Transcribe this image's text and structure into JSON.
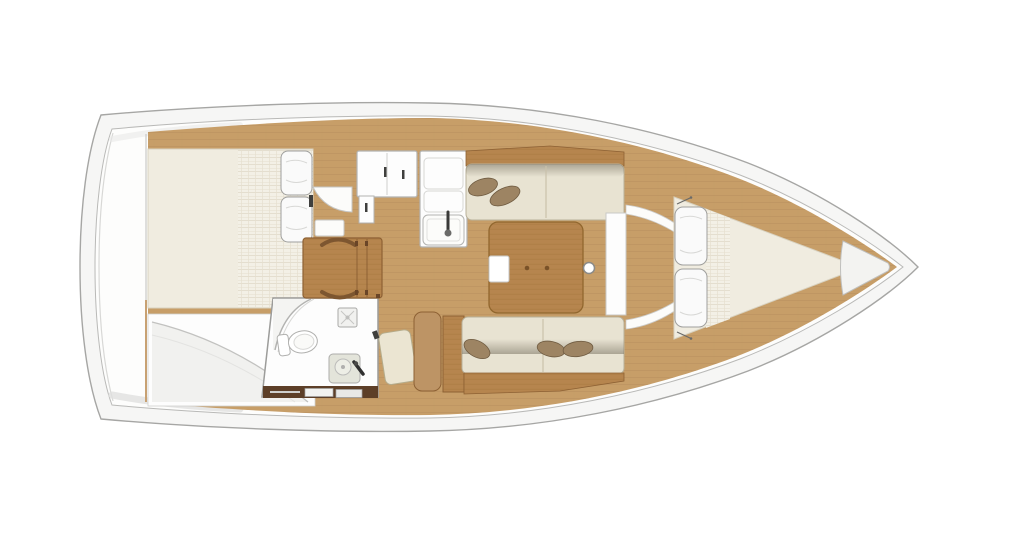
{
  "canvas": {
    "width": 1024,
    "height": 546,
    "background": "#ffffff"
  },
  "diagram": {
    "type": "sailboat-interior-floor-plan",
    "orientation": "stern-left-bow-right",
    "zones": [
      {
        "id": "aft-cabin",
        "description": "aft double berth with quilt and two pillows"
      },
      {
        "id": "aft-seat",
        "description": "curved seat and locker area aft"
      },
      {
        "id": "head",
        "description": "head compartment with shower, toilet, washbasin"
      },
      {
        "id": "galley",
        "description": "L-shaped galley with lockers, stove and sink"
      },
      {
        "id": "nav-station",
        "description": "chart table with bench"
      },
      {
        "id": "salon",
        "description": "two facing settees with throw pillows and centre table"
      },
      {
        "id": "mast-post",
        "description": "mast compression post"
      },
      {
        "id": "bow-cabin",
        "description": "V-berth with two pillows"
      },
      {
        "id": "bow-locker",
        "description": "anchor locker wedge at the stem"
      }
    ]
  },
  "palette": {
    "hull_band": "#f6f6f5",
    "hull_line": "#a6a6a4",
    "deck_white": "#fdfdfc",
    "floor_wood": "#c79e68",
    "furniture_wood": "#b6854e",
    "furniture_wood_line": "#8d6134",
    "trim_wood": "#bd9465",
    "mattress": "#f0ece0",
    "mattress_edge": "#d8d2c0",
    "cushion": "#e8e3d2",
    "cushion_edge": "#b9b19a",
    "pillow_white": "#fafafa",
    "pillow_brown": "#9d8463",
    "fixture_white": "#fdfdfd",
    "fixture_line": "#b3b3b1",
    "basin": "#e3e4da",
    "joinery_dark": "#5d3f28",
    "hardware_dark": "#3f3f3d",
    "door_cream": "#ebe5d2"
  }
}
